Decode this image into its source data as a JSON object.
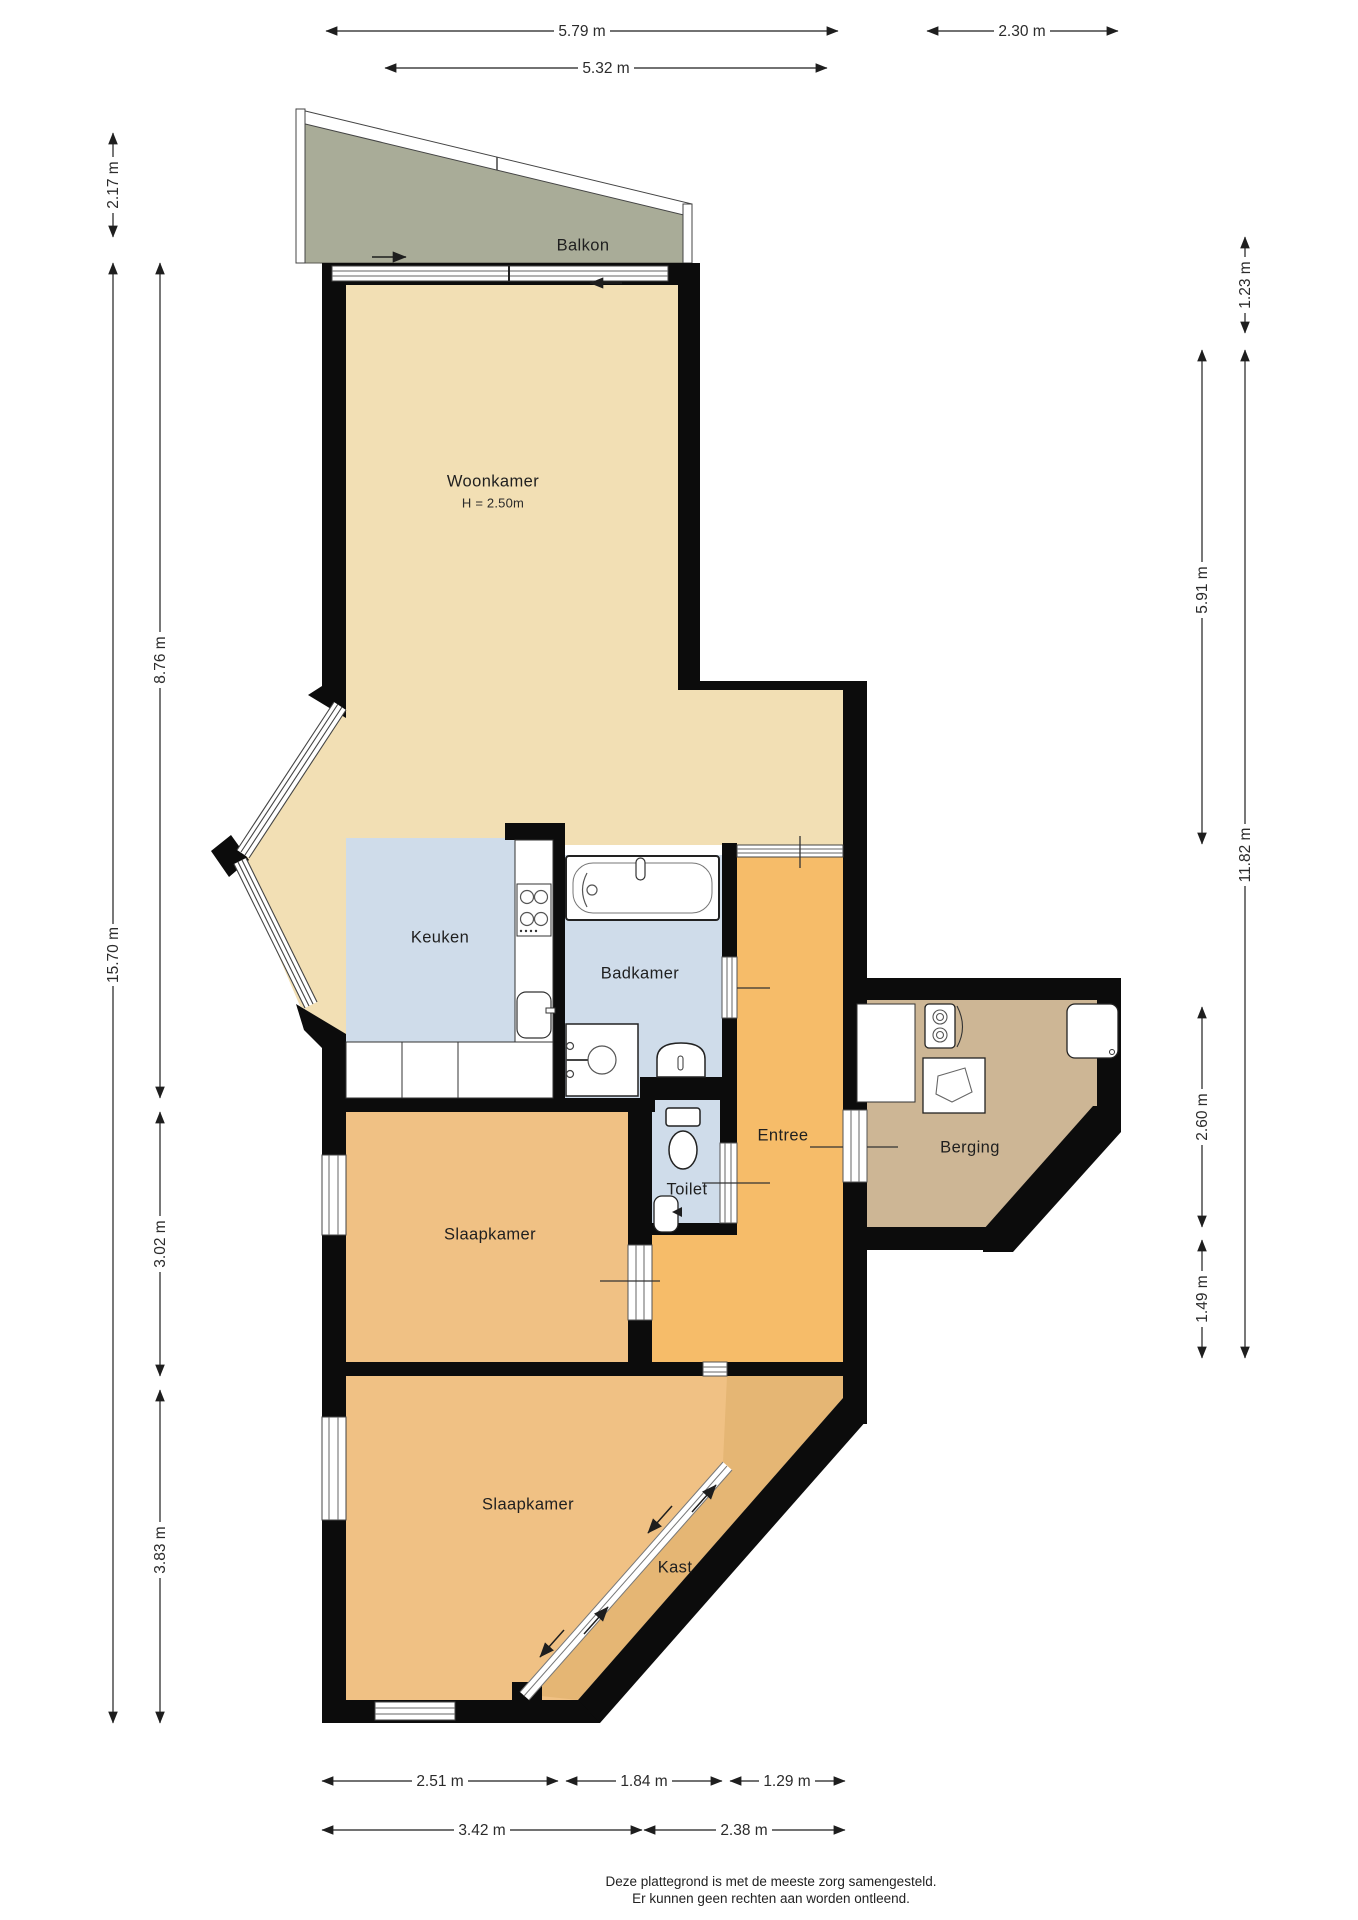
{
  "plan": {
    "rooms": {
      "balkon": {
        "label": "Balkon"
      },
      "woonkamer": {
        "label": "Woonkamer",
        "ceiling_height": "H = 2.50m"
      },
      "keuken": {
        "label": "Keuken"
      },
      "badkamer": {
        "label": "Badkamer"
      },
      "toilet": {
        "label": "Toilet"
      },
      "entree": {
        "label": "Entree"
      },
      "berging": {
        "label": "Berging"
      },
      "slaapkamer_midden": {
        "label": "Slaapkamer"
      },
      "slaapkamer_onder": {
        "label": "Slaapkamer"
      },
      "kast": {
        "label": "Kast"
      }
    },
    "dimensions": {
      "top_outer": "5.79 m",
      "top_inner": "5.32 m",
      "top_right": "2.30 m",
      "left_balkon": "2.17 m",
      "left_totaal": "15.70 m",
      "left_boven": "8.76 m",
      "left_midden": "3.02 m",
      "left_onder": "3.83 m",
      "right_balkon": "1.23 m",
      "right_boven": "5.91 m",
      "right_totaal": "11.82 m",
      "right_berging": "2.60 m",
      "right_entree": "1.49 m",
      "bottom_links": "2.51 m",
      "bottom_midden": "1.84 m",
      "bottom_rechts": "1.29 m",
      "bottom_binnen_links": "3.42 m",
      "bottom_binnen_rechts": "2.38 m"
    },
    "colors": {
      "woonkamer_floor": "#F2DFB4",
      "slaapkamer_floor": "#F0C184",
      "entree_floor": "#F6BC69",
      "natte_ruimte_floor": "#CFDCEA",
      "berging_floor": "#CDB695",
      "kast_floor": "#E5B674",
      "balkon_floor": "#A9AC98",
      "wall": "#0c0c0c"
    },
    "footer": {
      "line1": "Deze plattegrond is met de meeste zorg samengesteld.",
      "line2": "Er kunnen geen rechten aan worden ontleend."
    }
  }
}
